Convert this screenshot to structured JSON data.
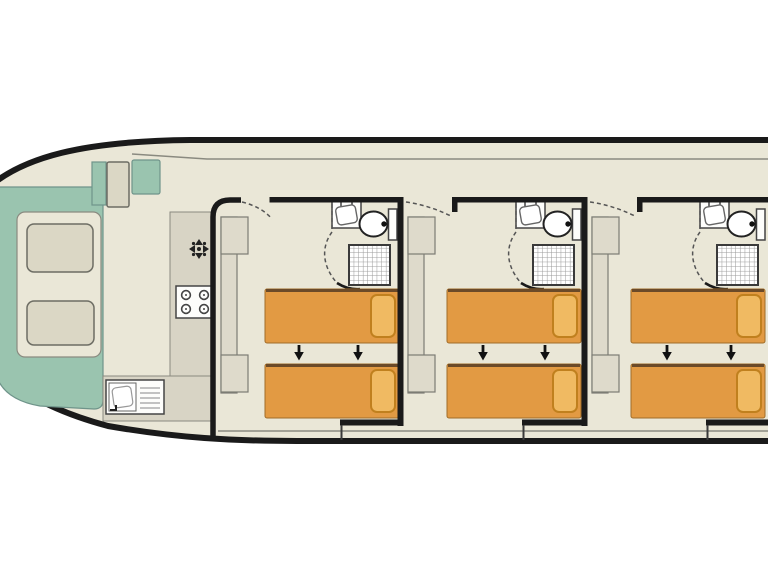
{
  "app": {
    "type": "houseboat-deck-plan",
    "description": "Top-down floor plan of a canal boat: bow lounge with cushioned seating, galley with stove and sink, and three identical double cabins each with two single beds and an en-suite shower room",
    "visible_text": []
  },
  "colors": {
    "page": "#FFFFFF",
    "hull": "#EAE7D7",
    "wall": "#1A1A1A",
    "line": "#8A8A80",
    "deck": "#9AC4AF",
    "cushion": "#DBD7C5",
    "counter": "#D8D4C5",
    "wardrobe": "#DEDACB",
    "bed": "#E29A43",
    "pillow": "#F0BA62",
    "pillow_edge": "#C0801E"
  },
  "bow": {
    "deck_color_name": "teal",
    "seat_cushions": 2,
    "step_boxes": 2
  },
  "galley": {
    "fixtures": [
      "vent-icon",
      "stove-4-burner",
      "sink-with-drainer"
    ],
    "stove_burners": 4
  },
  "cabins": [
    {
      "id": 1,
      "beds": 2,
      "pillows": 2,
      "join_arrows": 2,
      "wardrobes": 2,
      "bathroom": [
        "washbasin",
        "toilet",
        "shower"
      ]
    },
    {
      "id": 2,
      "beds": 2,
      "pillows": 2,
      "join_arrows": 2,
      "wardrobes": 2,
      "bathroom": [
        "washbasin",
        "toilet",
        "shower"
      ]
    },
    {
      "id": 3,
      "beds": 2,
      "pillows": 2,
      "join_arrows": 2,
      "wardrobes": 2,
      "bathroom": [
        "washbasin",
        "toilet",
        "shower"
      ]
    }
  ],
  "counts": {
    "cabins": 3,
    "total_beds": 6,
    "bathrooms": 3
  }
}
